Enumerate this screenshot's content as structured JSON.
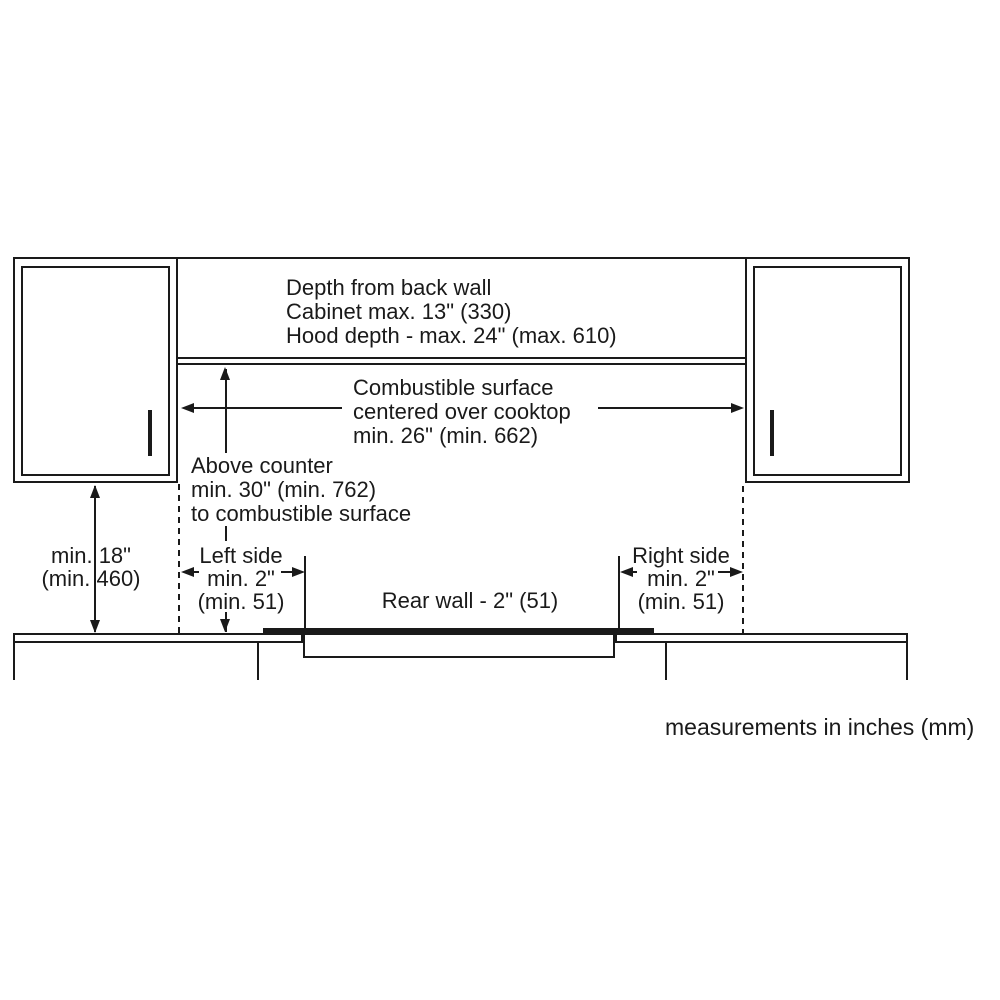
{
  "labels": {
    "depth_note": {
      "lines": [
        "Depth from back wall",
        "Cabinet max. 13\" (330)",
        "Hood depth - max. 24\" (max. 610)"
      ]
    },
    "combustible": {
      "lines": [
        "Combustible surface",
        "centered over cooktop",
        "min. 26\" (min. 662)"
      ]
    },
    "above_counter": {
      "lines": [
        "Above counter",
        "min. 30\" (min. 762)",
        "to combustible surface"
      ]
    },
    "min_18": {
      "lines": [
        "min. 18\"",
        "(min. 460)"
      ]
    },
    "left_side": {
      "lines": [
        "Left side",
        "min. 2\"",
        "(min. 51)"
      ]
    },
    "right_side": {
      "lines": [
        "Right side",
        "min. 2\"",
        "(min. 51)"
      ]
    },
    "rear_wall": {
      "text": "Rear wall - 2\" (51)"
    },
    "units_note": {
      "text": "measurements in inches (mm)"
    }
  },
  "colors": {
    "ink": "#1a1a1a",
    "background": "#ffffff"
  }
}
